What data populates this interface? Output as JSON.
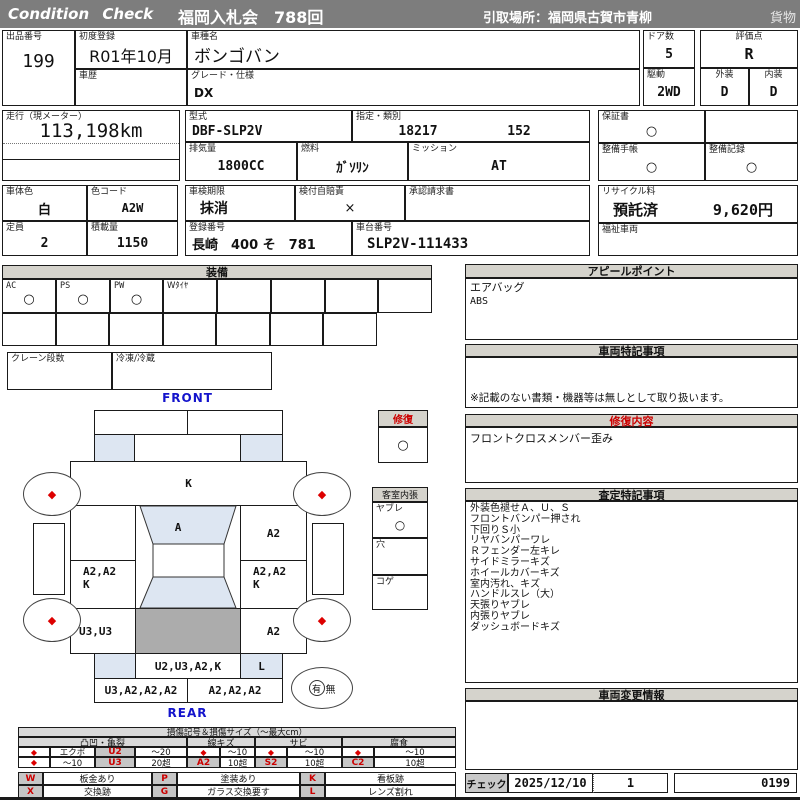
{
  "colors": {
    "topbar": "#7d7d7d",
    "section_header": "#d5d3cc",
    "accent_red": "#cc0000",
    "accent_blue": "#1414cc",
    "panel_shade": "#dde6f2",
    "roof_gray": "#acacac"
  },
  "header": {
    "brand": "Condition  Check",
    "title": "福岡入札会　788回",
    "pickup": "引取場所：福岡県古賀市青柳",
    "category": "貨物"
  },
  "info": {
    "lot": {
      "label": "出品番号",
      "value": "199"
    },
    "first_reg": {
      "label": "初度登録",
      "value": "R01年10月"
    },
    "history": {
      "label": "車歴",
      "value": ""
    },
    "model_name": {
      "label": "車種名",
      "value": "ボンゴバン"
    },
    "grade": {
      "label": "グレード・仕様",
      "value": "DX"
    },
    "doors": {
      "label": "ドア数",
      "value": "5"
    },
    "drive": {
      "label": "駆動",
      "value": "2WD"
    },
    "score": {
      "label": "評価点",
      "value": "R"
    },
    "exterior": {
      "label": "外装",
      "value": "D"
    },
    "interior": {
      "label": "内装",
      "value": "D"
    },
    "mileage": {
      "label": "走行（現メーター）",
      "value": "113,198km"
    },
    "model_code": {
      "label": "型式",
      "value": "DBF-SLP2V"
    },
    "class_no": {
      "label": "指定・類別",
      "value1": "18217",
      "value2": "152"
    },
    "warranty": {
      "label": "保証書",
      "value": "○"
    },
    "displacement": {
      "label": "排気量",
      "value": "1800CC"
    },
    "fuel": {
      "label": "燃料",
      "value": "ｶﾞｿﾘﾝ"
    },
    "transmission": {
      "label": "ミッション",
      "value": "AT"
    },
    "maintenance_book": {
      "label": "整備手帳",
      "value": "○"
    },
    "maintenance_record": {
      "label": "整備記録",
      "value": "○"
    },
    "body_color": {
      "label": "車体色",
      "value": "白"
    },
    "color_code": {
      "label": "色コード",
      "value": "A2W"
    },
    "inspection": {
      "label": "車検期限",
      "value": "抹消"
    },
    "insurance": {
      "label": "検付自賠責",
      "value": "×"
    },
    "approval": {
      "label": "承認請求書",
      "value": ""
    },
    "recycle": {
      "label": "リサイクル料",
      "status": "預託済",
      "fee": "9,620円"
    },
    "capacity": {
      "label": "定員",
      "value": "2"
    },
    "load": {
      "label": "積載量",
      "value": "1150"
    },
    "reg_no": {
      "label": "登録番号",
      "value": "長崎　400 そ　781"
    },
    "chassis_no": {
      "label": "車台番号",
      "value": "SLP2V-111433"
    },
    "welfare": {
      "label": "福祉車両",
      "value": ""
    }
  },
  "equipment": {
    "title": "装備",
    "row1": [
      {
        "label": "AC",
        "value": "○"
      },
      {
        "label": "PS",
        "value": "○"
      },
      {
        "label": "PW",
        "value": "○"
      },
      {
        "label": "Wﾀｲﾔ",
        "value": ""
      },
      {
        "label": "",
        "value": ""
      },
      {
        "label": "",
        "value": ""
      },
      {
        "label": "",
        "value": ""
      },
      {
        "label": "",
        "value": ""
      }
    ],
    "crane": {
      "label": "クレーン段数",
      "value": ""
    },
    "refrigeration": {
      "label": "冷凍/冷蔵",
      "value": ""
    }
  },
  "appeal": {
    "title": "アピールポイント",
    "lines": [
      "エアバッグ",
      "ABS"
    ]
  },
  "vehicle_notes": {
    "title": "車両特記事項",
    "note": "※記載のない書類・機器等は無しとして取り扱います。"
  },
  "repair_details": {
    "title": "修復内容",
    "lines": [
      "フロントクロスメンバー歪み"
    ]
  },
  "assessment": {
    "title": "査定特記事項",
    "lines": [
      "外装色褪せＡ、Ｕ、Ｓ",
      "フロントバンパー押され",
      "下回りＳ小",
      "リヤバンパーワレ",
      "Ｒフェンダー左キレ",
      "サイドミラーキズ",
      "ホイールカバーキズ",
      "室内汚れ、キズ",
      "ハンドルスレ（大）",
      "天張りヤブレ",
      "内張りヤブレ",
      "ダッシュボードキズ"
    ]
  },
  "change_info": {
    "title": "車両変更情報"
  },
  "check": {
    "label": "チェック",
    "date": "2025/12/10",
    "count": "1",
    "number": "0199"
  },
  "diagram": {
    "front_label": "FRONT",
    "rear_label": "REAR",
    "hood": "K",
    "windshield": "A",
    "cowl_right": "A2",
    "door_left_line1": "A2,A2",
    "door_left_line2": "K",
    "door_right_line1": "A2,A2",
    "door_right_line2": "K",
    "side_left": "U3,U3",
    "side_right": "A2",
    "rear_gate": "U2,U3,A2,K",
    "tail_lamp": "L",
    "rear_bumper_left": "U3,A2,A2,A2",
    "rear_bumper_right": "A2,A2,A2",
    "wheel_mark": "◆",
    "repair": {
      "title": "修復",
      "value": "○"
    },
    "cabin": {
      "title": "客室内張",
      "rows": [
        {
          "label": "ヤブレ",
          "value": "○"
        },
        {
          "label": "穴",
          "value": ""
        },
        {
          "label": "コゲ",
          "value": ""
        }
      ]
    },
    "spare": {
      "present": "有",
      "absent": "無"
    }
  },
  "legend": {
    "title": "損傷記号＆損傷サイズ（〜最大cm）",
    "col_headers": [
      "凸凹・亀裂",
      "線キズ",
      "サビ",
      "腐食"
    ],
    "row1": {
      "m1": "◆",
      "t1": "エクボ",
      "c1": "U2",
      "s1": "〜20",
      "m2": "◆",
      "s2": "〜10",
      "m3": "◆",
      "s3": "〜10",
      "m4": "◆",
      "s4": "〜10"
    },
    "row2": {
      "m1": "◆",
      "t1": "〜10",
      "c1": "U3",
      "s1": "20超",
      "c2": "A2",
      "s2": "10超",
      "c3": "S2",
      "s3": "10超",
      "c4": "C2",
      "s4": "10超"
    },
    "codes": {
      "w": {
        "code": "W",
        "text": "板金あり"
      },
      "p": {
        "code": "P",
        "text": "塗装あり"
      },
      "k": {
        "code": "K",
        "text": "看板跡"
      },
      "x": {
        "code": "X",
        "text": "交換跡"
      },
      "g": {
        "code": "G",
        "text": "ガラス交換要す"
      },
      "l": {
        "code": "L",
        "text": "レンズ割れ"
      }
    }
  }
}
